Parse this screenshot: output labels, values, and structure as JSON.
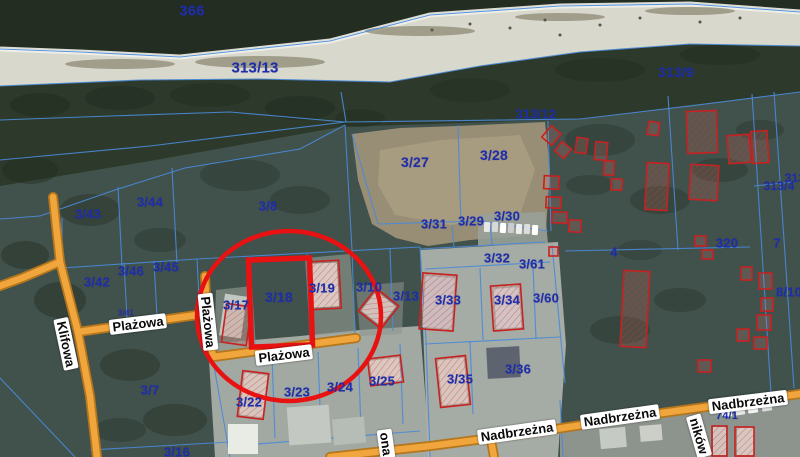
{
  "map": {
    "colors": {
      "land": "#41514c",
      "sea": "#232d22",
      "beach": "#d8d8cc",
      "dune": "#2d3a2b",
      "boundary": "#4a8ad8",
      "road_fill": "#f0a63c",
      "road_border": "#b5761c",
      "highlight_red": "#e81212",
      "building_red": "#c62222",
      "parcel_text": "#1f2ea8"
    },
    "street_labels": [
      {
        "t": "Klifowa",
        "x": 66,
        "y": 344,
        "rot": 78
      },
      {
        "t": "Plażowa",
        "x": 138,
        "y": 324,
        "rot": -7
      },
      {
        "t": "Plażowa",
        "x": 208,
        "y": 322,
        "rot": 84
      },
      {
        "t": "Plażowa",
        "x": 284,
        "y": 355,
        "rot": -7
      },
      {
        "t": "Nadbrzeżna",
        "x": 517,
        "y": 432,
        "rot": -8
      },
      {
        "t": "Nadbrzeżna",
        "x": 620,
        "y": 417,
        "rot": -8
      },
      {
        "t": "Nadbrzeżna",
        "x": 748,
        "y": 402,
        "rot": -7
      },
      {
        "t": "ona",
        "x": 386,
        "y": 444,
        "rot": 82
      },
      {
        "t": "ników",
        "x": 699,
        "y": 436,
        "rot": 74
      }
    ],
    "parcel_labels": [
      {
        "t": "366",
        "x": 192,
        "y": 11,
        "s": 15
      },
      {
        "t": "313/13",
        "x": 255,
        "y": 68,
        "s": 15
      },
      {
        "t": "313/9",
        "x": 676,
        "y": 72,
        "s": 14
      },
      {
        "t": "313/12",
        "x": 536,
        "y": 114,
        "s": 13
      },
      {
        "t": "3/27",
        "x": 415,
        "y": 162,
        "s": 14
      },
      {
        "t": "3/28",
        "x": 494,
        "y": 155,
        "s": 14
      },
      {
        "t": "3/31",
        "x": 434,
        "y": 224,
        "s": 13
      },
      {
        "t": "3/29",
        "x": 471,
        "y": 221,
        "s": 13
      },
      {
        "t": "3/30",
        "x": 507,
        "y": 216,
        "s": 13
      },
      {
        "t": "3/43",
        "x": 88,
        "y": 214,
        "s": 13
      },
      {
        "t": "3/44",
        "x": 150,
        "y": 202,
        "s": 13
      },
      {
        "t": "3/8",
        "x": 268,
        "y": 206,
        "s": 13
      },
      {
        "t": "3/42",
        "x": 97,
        "y": 282,
        "s": 13
      },
      {
        "t": "3/46",
        "x": 131,
        "y": 271,
        "s": 13
      },
      {
        "t": "3/45",
        "x": 166,
        "y": 267,
        "s": 13
      },
      {
        "t": "3/41",
        "x": 126,
        "y": 313,
        "s": 8,
        "o": 0.85
      },
      {
        "t": "3/17",
        "x": 236,
        "y": 305,
        "s": 13
      },
      {
        "t": "3/18",
        "x": 279,
        "y": 297,
        "s": 14
      },
      {
        "t": "3/19",
        "x": 322,
        "y": 288,
        "s": 13
      },
      {
        "t": "3/10",
        "x": 369,
        "y": 287,
        "s": 13
      },
      {
        "t": "3/13",
        "x": 406,
        "y": 296,
        "s": 13
      },
      {
        "t": "3/32",
        "x": 497,
        "y": 258,
        "s": 13
      },
      {
        "t": "3/61",
        "x": 532,
        "y": 264,
        "s": 13
      },
      {
        "t": "3/33",
        "x": 448,
        "y": 300,
        "s": 13
      },
      {
        "t": "3/34",
        "x": 507,
        "y": 300,
        "s": 13
      },
      {
        "t": "3/60",
        "x": 546,
        "y": 298,
        "s": 13
      },
      {
        "t": "3/22",
        "x": 249,
        "y": 402,
        "s": 13
      },
      {
        "t": "3/23",
        "x": 297,
        "y": 392,
        "s": 13
      },
      {
        "t": "3/24",
        "x": 340,
        "y": 387,
        "s": 13
      },
      {
        "t": "3/25",
        "x": 382,
        "y": 381,
        "s": 13
      },
      {
        "t": "3/35",
        "x": 460,
        "y": 379,
        "s": 13
      },
      {
        "t": "3/36",
        "x": 518,
        "y": 369,
        "s": 13
      },
      {
        "t": "3/7",
        "x": 150,
        "y": 390,
        "s": 13
      },
      {
        "t": "3/16",
        "x": 177,
        "y": 452,
        "s": 13
      },
      {
        "t": "4",
        "x": 614,
        "y": 252,
        "s": 13
      },
      {
        "t": "320",
        "x": 727,
        "y": 243,
        "s": 13
      },
      {
        "t": "7",
        "x": 777,
        "y": 243,
        "s": 13
      },
      {
        "t": "313/4",
        "x": 779,
        "y": 186,
        "s": 12
      },
      {
        "t": "313",
        "x": 795,
        "y": 178,
        "s": 12
      },
      {
        "t": "8/10",
        "x": 789,
        "y": 292,
        "s": 13
      },
      {
        "t": "74/1",
        "x": 727,
        "y": 416,
        "s": 11
      }
    ],
    "highlight": {
      "circle": {
        "cx": 289,
        "cy": 316,
        "rx": 92,
        "ry": 85,
        "sw": 4.5
      },
      "rect": {
        "x": 250,
        "y": 259,
        "w": 61,
        "h": 87,
        "rot": -2,
        "sw": 5.5
      }
    },
    "terrain": [
      {
        "p": "0,0 800,0 800,12 690,4 560,6 430,15 330,41 180,57 80,52 0,49",
        "f": "#232d22"
      },
      {
        "p": "0,49 80,52 180,57 330,41 430,15 560,6 690,4 800,12 800,46 690,44 580,52 480,66 390,82 260,79 140,80 0,86",
        "f": "#d8d8cc"
      },
      {
        "p": "0,86 140,80 260,79 390,82 480,66 580,52 690,44 800,46 800,92 690,105 580,119 340,127 150,161 0,186",
        "f": "#2d3a2b"
      },
      {
        "p": "352,134 400,128 458,126 545,122 550,170 546,230 520,236 470,240 428,246 396,238 372,224 358,180",
        "f": "#988d75"
      },
      {
        "p": "380,150 440,140 520,135 535,170 520,215 450,225 395,215 378,185",
        "f": "#ab9f83",
        "o": 0.8
      },
      {
        "p": "208,344 300,336 360,330 420,326 430,457 215,457",
        "f": "#aab0a9",
        "o": 0.92
      },
      {
        "p": "420,250 558,242 566,345 558,457 428,457",
        "f": "#b0b5af",
        "o": 0.9
      },
      {
        "p": "560,425 700,410 800,394 800,457 560,457",
        "f": "#9aa099",
        "o": 0.85
      },
      {
        "p": "478,214 545,212 548,244 478,246",
        "f": "#99a198",
        "o": 0.9
      },
      {
        "p": "216,290 252,286 256,348 214,352",
        "f": "#8f978f",
        "o": 0.65
      },
      {
        "p": "305,258 350,254 356,332 310,336",
        "f": "#949c94",
        "o": 0.6
      },
      {
        "p": "356,286 404,282 402,334 360,336",
        "f": "#8e968e",
        "o": 0.55
      }
    ],
    "foam": "0,49 80,52 180,57 330,41 430,15 560,6 690,4 800,12",
    "trees": [
      [
        40,
        105,
        30,
        12,
        0.5
      ],
      [
        120,
        98,
        35,
        12,
        0.45
      ],
      [
        210,
        95,
        40,
        12,
        0.4
      ],
      [
        300,
        108,
        35,
        12,
        0.45
      ],
      [
        360,
        118,
        25,
        9,
        0.4
      ],
      [
        470,
        90,
        40,
        12,
        0.35
      ],
      [
        600,
        70,
        45,
        12,
        0.4
      ],
      [
        720,
        55,
        40,
        10,
        0.4
      ],
      [
        30,
        170,
        28,
        14,
        0.4
      ],
      [
        90,
        210,
        30,
        16,
        0.35
      ],
      [
        240,
        175,
        40,
        16,
        0.3
      ],
      [
        60,
        300,
        26,
        18,
        0.4
      ],
      [
        25,
        255,
        24,
        14,
        0.4
      ],
      [
        130,
        365,
        30,
        16,
        0.35
      ],
      [
        175,
        420,
        32,
        16,
        0.35
      ],
      [
        120,
        430,
        26,
        12,
        0.3
      ],
      [
        600,
        140,
        35,
        16,
        0.3
      ],
      [
        660,
        200,
        30,
        14,
        0.3
      ],
      [
        720,
        170,
        28,
        12,
        0.3
      ],
      [
        760,
        130,
        24,
        10,
        0.3
      ],
      [
        620,
        330,
        30,
        14,
        0.3
      ],
      [
        680,
        300,
        26,
        12,
        0.3
      ],
      [
        590,
        185,
        24,
        10,
        0.28
      ],
      [
        640,
        250,
        22,
        10,
        0.25
      ],
      [
        300,
        200,
        30,
        14,
        0.3
      ],
      [
        160,
        240,
        26,
        12,
        0.3
      ]
    ],
    "beach_dots": [
      [
        432,
        30
      ],
      [
        470,
        24
      ],
      [
        510,
        28
      ],
      [
        545,
        20
      ],
      [
        600,
        25
      ],
      [
        640,
        18
      ],
      [
        700,
        22
      ],
      [
        560,
        35
      ],
      [
        740,
        18
      ]
    ],
    "beach_weeds": [
      [
        120,
        64,
        55,
        5
      ],
      [
        260,
        62,
        65,
        6
      ],
      [
        420,
        31,
        55,
        5
      ],
      [
        560,
        17,
        45,
        4
      ],
      [
        690,
        11,
        45,
        4
      ]
    ],
    "boundaries": [
      "0,49 80,52 180,57 330,41 430,15 560,6 690,4 800,12",
      "0,86 140,80 260,79 390,82 480,66 580,52 690,44 800,46",
      "0,120 110,116 230,112 345,122",
      "0,160 150,146 345,122 580,119 690,106 800,92",
      "341,92 346,122",
      "40,216 115,190 185,168 300,149 345,125",
      "0,219 40,216",
      "118,187 122,266",
      "172,168 177,264",
      "62,268 197,259",
      "124,263 127,318",
      "154,261 157,317",
      "197,259 200,317",
      "62,218 62,268",
      "197,259 420,247",
      "250,257 254,347",
      "307,254 310,340",
      "352,251 355,334",
      "390,249 393,331",
      "420,247 426,340 430,457",
      "345,125 352,250",
      "352,134 378,224",
      "378,224 480,221 548,231",
      "458,125 461,227",
      "548,121 551,231",
      "452,225 454,247",
      "490,223 492,245",
      "420,249 545,242",
      "552,245 565,383",
      "480,268 483,340",
      "533,266 536,339",
      "425,269 550,262",
      "425,344 560,337",
      "470,341 473,414",
      "272,357 275,438",
      "318,352 321,434",
      "358,348 361,429",
      "400,344 403,424",
      "233,446 420,431",
      "213,360 230,457",
      "90,450 230,442",
      "0,378 75,457",
      "752,94 771,394",
      "774,92 794,388",
      "754,186 793,182",
      "565,251 750,247",
      "668,96 678,250",
      "560,400 563,457"
    ],
    "roads": [
      {
        "d": "M53,197 L60,262 L78,332 L90,396 L97,457"
      },
      {
        "d": "M60,262 L22,278 L0,286"
      },
      {
        "d": "M78,332 L140,323 L197,315"
      },
      {
        "d": "M205,276 L207,316 L213,357"
      },
      {
        "d": "M213,357 L280,348 L356,338"
      },
      {
        "d": "M330,457 L430,446 L530,433 L640,416 L735,403 L800,394"
      },
      {
        "d": "M491,440 L494,457"
      }
    ],
    "buildings_gray": [
      [
        222,
        295,
        22,
        42,
        8,
        "#c2c7c1"
      ],
      [
        312,
        263,
        26,
        44,
        -3,
        "#d6dad5"
      ],
      [
        366,
        296,
        25,
        25,
        38,
        "#ccd1cc"
      ],
      [
        424,
        277,
        29,
        51,
        4,
        "#c4cad2"
      ],
      [
        495,
        288,
        25,
        40,
        -4,
        "#cdd3d9"
      ],
      [
        487,
        347,
        33,
        31,
        -3,
        "#5d6470"
      ],
      [
        242,
        374,
        23,
        42,
        7,
        "#d2d6d0"
      ],
      [
        371,
        359,
        29,
        23,
        -7,
        "#d6d8d2"
      ],
      [
        440,
        359,
        26,
        45,
        -6,
        "#d4d6d0"
      ],
      [
        228,
        424,
        30,
        30,
        0,
        "#e9ebe5"
      ],
      [
        288,
        406,
        42,
        38,
        -4,
        "#c3c8c2"
      ],
      [
        333,
        418,
        32,
        26,
        -5,
        "#b6bcb6"
      ],
      [
        713,
        427,
        13,
        28,
        0,
        "#cfd3cf"
      ],
      [
        737,
        428,
        17,
        27,
        0,
        "#d4d8d4"
      ],
      [
        600,
        428,
        26,
        20,
        -5,
        "#c6cac4"
      ],
      [
        640,
        425,
        22,
        16,
        -5,
        "#cccfc8"
      ]
    ],
    "cars": [
      [
        484,
        222,
        6,
        10,
        3,
        "#e8e8e8"
      ],
      [
        492,
        222,
        6,
        10,
        3,
        "#d8d8d8"
      ],
      [
        500,
        223,
        6,
        10,
        3,
        "#ffffff"
      ],
      [
        508,
        223,
        6,
        10,
        3,
        "#cccccc"
      ],
      [
        516,
        224,
        6,
        10,
        3,
        "#eeeeee"
      ],
      [
        524,
        224,
        6,
        10,
        3,
        "#dddddd"
      ],
      [
        532,
        225,
        6,
        10,
        3,
        "#ffffff"
      ],
      [
        722,
        412,
        10,
        5,
        -8,
        "#ffffff"
      ],
      [
        735,
        410,
        10,
        5,
        -8,
        "#e8e8e8"
      ],
      [
        748,
        408,
        10,
        5,
        -8,
        "#f4f4f4"
      ],
      [
        762,
        406,
        10,
        5,
        -8,
        "#dddddd"
      ]
    ],
    "buildings_red": [
      [
        224,
        305,
        25,
        39,
        8,
        1
      ],
      [
        309,
        261,
        31,
        48,
        -3,
        1
      ],
      [
        364,
        294,
        29,
        29,
        38,
        1
      ],
      [
        421,
        274,
        34,
        56,
        4,
        1
      ],
      [
        492,
        285,
        30,
        45,
        -4,
        1
      ],
      [
        240,
        372,
        26,
        46,
        7,
        1
      ],
      [
        369,
        357,
        33,
        27,
        -7,
        1
      ],
      [
        438,
        357,
        30,
        49,
        -6,
        1
      ],
      [
        622,
        271,
        26,
        76,
        3,
        1
      ],
      [
        646,
        163,
        22,
        47,
        3,
        1
      ],
      [
        687,
        111,
        30,
        42,
        -2,
        1
      ],
      [
        728,
        135,
        22,
        28,
        -4,
        1
      ],
      [
        752,
        131,
        16,
        32,
        -4,
        1
      ],
      [
        690,
        165,
        28,
        35,
        3,
        1
      ],
      [
        648,
        122,
        11,
        13,
        8,
        0
      ],
      [
        545,
        128,
        13,
        15,
        40,
        0
      ],
      [
        557,
        144,
        12,
        12,
        40,
        0
      ],
      [
        576,
        138,
        11,
        15,
        8,
        0
      ],
      [
        595,
        142,
        12,
        18,
        5,
        0
      ],
      [
        544,
        176,
        15,
        13,
        3,
        0
      ],
      [
        546,
        197,
        15,
        11,
        3,
        0
      ],
      [
        552,
        212,
        15,
        11,
        3,
        0
      ],
      [
        569,
        220,
        12,
        12,
        3,
        0
      ],
      [
        604,
        161,
        10,
        14,
        3,
        0
      ],
      [
        611,
        179,
        11,
        11,
        3,
        0
      ],
      [
        741,
        267,
        11,
        13,
        0,
        0
      ],
      [
        759,
        273,
        13,
        16,
        0,
        0
      ],
      [
        761,
        298,
        12,
        13,
        0,
        0
      ],
      [
        757,
        315,
        14,
        15,
        0,
        0
      ],
      [
        737,
        329,
        12,
        12,
        0,
        0
      ],
      [
        754,
        337,
        13,
        12,
        0,
        0
      ],
      [
        712,
        426,
        15,
        30,
        0,
        1
      ],
      [
        735,
        427,
        19,
        29,
        0,
        1
      ],
      [
        695,
        236,
        11,
        10,
        0,
        0
      ],
      [
        702,
        250,
        11,
        9,
        0,
        0
      ],
      [
        549,
        247,
        9,
        9,
        0,
        0
      ],
      [
        698,
        360,
        13,
        12,
        0,
        0
      ]
    ]
  }
}
